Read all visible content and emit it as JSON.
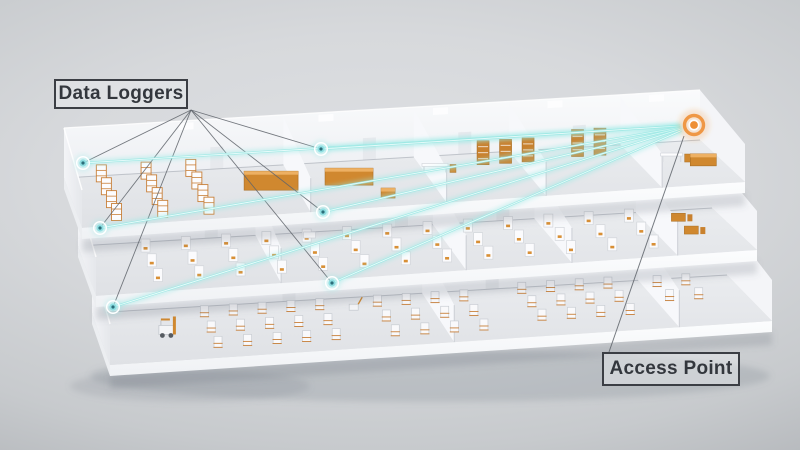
{
  "title": "Wireless data loggers reporting to an access point across three warehouse floors",
  "callouts": {
    "data_loggers": {
      "label": "Data Loggers",
      "box": {
        "x": 54,
        "y": 79,
        "w": 134,
        "h": 30
      },
      "fan_origin": {
        "x": 191,
        "y": 110
      }
    },
    "access_point": {
      "label": "Access Point",
      "box": {
        "x": 602,
        "y": 352,
        "w": 138,
        "h": 34
      },
      "leader_start": {
        "x": 609,
        "y": 352
      },
      "leader_end": {
        "x": 684,
        "y": 136
      }
    }
  },
  "diagram": {
    "access_point": {
      "x": 694,
      "y": 125
    },
    "data_loggers": [
      {
        "id": "logger-1",
        "floor": "top",
        "x": 83,
        "y": 163
      },
      {
        "id": "logger-2",
        "floor": "top",
        "x": 321,
        "y": 149
      },
      {
        "id": "logger-3",
        "floor": "middle",
        "x": 100,
        "y": 228
      },
      {
        "id": "logger-4",
        "floor": "middle",
        "x": 323,
        "y": 212
      },
      {
        "id": "logger-5",
        "floor": "bottom",
        "x": 113,
        "y": 307
      },
      {
        "id": "logger-6",
        "floor": "bottom",
        "x": 332,
        "y": 283
      }
    ],
    "colors": {
      "signal": "#9fe8e4",
      "signal_core": "#f2fffe",
      "marker_orange": "#ee8f35",
      "callout_border": "#3b3e44",
      "callout_text": "#33373d",
      "furniture_orange": "#d0882f",
      "annotation_line": "#5f646b"
    }
  }
}
